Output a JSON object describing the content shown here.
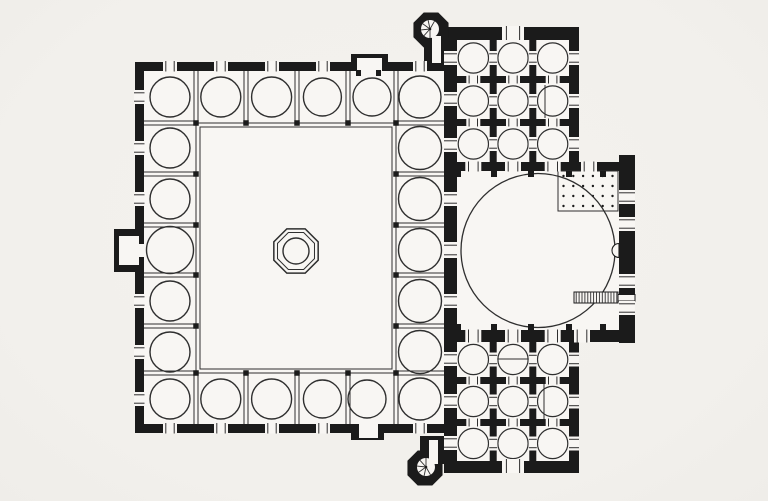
{
  "meta": {
    "description": "Scanned architectural floor plan of an Ottoman mosque: arcaded courtyard with central ablution fountain (left), domed prayer hall with flanking three-by-three domed wings (right), two spiral minarets, minbar and mihrab"
  },
  "palette": {
    "background": "#f2f0ec",
    "surface": "#f8f6f3",
    "ink": "#1b1b1b",
    "line": "#2f2f2f"
  },
  "canvas": {
    "width": 768,
    "height": 501
  },
  "plan": {
    "wallRects": [
      {
        "name": "courtyard-outer-wall",
        "r": [
          135,
          62,
          322,
          371
        ]
      },
      {
        "name": "shared-west-wall",
        "r": [
          444,
          28,
          13,
          445
        ]
      },
      {
        "name": "north-wing-block",
        "r": [
          444,
          27,
          135,
          144
        ]
      },
      {
        "name": "hall-north-wall-east",
        "r": [
          579,
          162,
          56,
          9
        ]
      },
      {
        "name": "hall-east-qibla-wall",
        "r": [
          619,
          155,
          16,
          188
        ]
      },
      {
        "name": "hall-south-wall",
        "r": [
          444,
          330,
          191,
          12
        ]
      },
      {
        "name": "south-wing-block",
        "r": [
          444,
          342,
          135,
          131
        ]
      }
    ],
    "floorRects": [
      {
        "name": "courtyard-arcade-floor",
        "r": [
          144,
          71,
          300,
          353
        ]
      },
      {
        "name": "prayer-hall-floor",
        "r": [
          457,
          171,
          162,
          159
        ]
      }
    ],
    "bays": [
      [
        457,
        40,
        32.7,
        36
      ],
      [
        496.7,
        40,
        32.6,
        36
      ],
      [
        536.3,
        40,
        32.7,
        36
      ],
      [
        457,
        83,
        32.7,
        36
      ],
      [
        496.7,
        83,
        32.6,
        36
      ],
      [
        536.3,
        83,
        32.7,
        36
      ],
      [
        457,
        126,
        32.7,
        36
      ],
      [
        496.7,
        126,
        32.6,
        36
      ],
      [
        536.3,
        126,
        32.7,
        36
      ],
      [
        457,
        342,
        32.7,
        35
      ],
      [
        496.7,
        342,
        32.6,
        35
      ],
      [
        536.3,
        342,
        32.7,
        35
      ],
      [
        457,
        384,
        32.7,
        35
      ],
      [
        496.7,
        384,
        32.6,
        35
      ],
      [
        536.3,
        384,
        32.7,
        35
      ],
      [
        457,
        426,
        32.7,
        35
      ],
      [
        496.7,
        426,
        32.6,
        35
      ],
      [
        536.3,
        426,
        32.7,
        35
      ]
    ],
    "arcadeFrame": [
      [
        196,
        123,
        200,
        250
      ],
      [
        200,
        127,
        192,
        242
      ]
    ],
    "dividers": [
      [
        "v",
        196,
        71,
        123
      ],
      [
        "v",
        246,
        71,
        123
      ],
      [
        "v",
        297,
        71,
        123
      ],
      [
        "v",
        348,
        71,
        123
      ],
      [
        "v",
        396,
        71,
        123
      ],
      [
        "v",
        196,
        373,
        424
      ],
      [
        "v",
        246,
        373,
        424
      ],
      [
        "v",
        297,
        373,
        424
      ],
      [
        "v",
        348,
        373,
        424
      ],
      [
        "v",
        396,
        373,
        424
      ],
      [
        "h",
        123,
        144,
        196
      ],
      [
        "h",
        174,
        144,
        196
      ],
      [
        "h",
        225,
        144,
        196
      ],
      [
        "h",
        275,
        144,
        196
      ],
      [
        "h",
        326,
        144,
        196
      ],
      [
        "h",
        373,
        144,
        196
      ],
      [
        "h",
        123,
        396,
        444
      ],
      [
        "h",
        174,
        396,
        444
      ],
      [
        "h",
        225,
        396,
        444
      ],
      [
        "h",
        275,
        396,
        444
      ],
      [
        "h",
        326,
        396,
        444
      ],
      [
        "h",
        373,
        396,
        444
      ]
    ],
    "piers": [
      [
        196,
        123
      ],
      [
        246,
        123
      ],
      [
        297,
        123
      ],
      [
        348,
        123
      ],
      [
        396,
        123
      ],
      [
        196,
        373
      ],
      [
        246,
        373
      ],
      [
        297,
        373
      ],
      [
        348,
        373
      ],
      [
        396,
        373
      ],
      [
        196,
        174
      ],
      [
        196,
        225
      ],
      [
        196,
        275
      ],
      [
        196,
        326
      ],
      [
        396,
        174
      ],
      [
        396,
        225
      ],
      [
        396,
        275
      ],
      [
        396,
        326
      ]
    ],
    "arcadeCircles": [
      [
        170,
        97,
        20
      ],
      [
        220.8,
        97,
        20
      ],
      [
        271.6,
        97,
        20
      ],
      [
        322.4,
        97,
        19
      ],
      [
        372,
        97,
        19
      ],
      [
        420,
        97,
        21
      ],
      [
        170,
        399,
        20
      ],
      [
        220.8,
        399,
        20
      ],
      [
        271.6,
        399,
        20
      ],
      [
        322.4,
        399,
        19
      ],
      [
        367,
        399,
        19
      ],
      [
        420,
        399,
        21
      ],
      [
        170,
        148,
        20
      ],
      [
        170,
        199,
        20
      ],
      [
        170,
        250,
        23.5
      ],
      [
        170,
        301,
        20
      ],
      [
        170,
        352,
        20
      ],
      [
        420,
        148,
        21.5
      ],
      [
        420,
        199,
        21.5
      ],
      [
        420,
        250,
        21.5
      ],
      [
        420,
        301,
        21.5
      ],
      [
        420,
        352,
        21.5
      ]
    ],
    "chordLines": [
      [
        545,
        85,
        545,
        118
      ],
      [
        497,
        359,
        530,
        359
      ],
      [
        544,
        384,
        544,
        419
      ]
    ],
    "windows": [
      [
        163,
        61,
        14,
        10.5,
        "h"
      ],
      [
        214,
        61,
        14,
        10.5,
        "h"
      ],
      [
        265,
        61,
        14,
        10.5,
        "h"
      ],
      [
        316,
        61,
        14,
        10.5,
        "h"
      ],
      [
        413,
        61,
        14,
        10.5,
        "h"
      ],
      [
        163,
        423,
        14,
        10.5,
        "h"
      ],
      [
        214,
        423,
        14,
        10.5,
        "h"
      ],
      [
        265,
        423,
        14,
        10.5,
        "h"
      ],
      [
        316,
        423,
        14,
        10.5,
        "h"
      ],
      [
        413,
        423,
        14,
        10.5,
        "h"
      ],
      [
        134,
        90,
        10.5,
        14,
        "v"
      ],
      [
        134,
        141,
        10.5,
        14,
        "v"
      ],
      [
        134,
        192,
        10.5,
        14,
        "v"
      ],
      [
        134,
        294,
        10.5,
        14,
        "v"
      ],
      [
        134,
        345,
        10.5,
        14,
        "v"
      ],
      [
        134,
        392,
        10.5,
        14,
        "v"
      ],
      [
        444,
        51,
        13,
        14,
        "v"
      ],
      [
        444,
        92,
        13,
        14,
        "v"
      ],
      [
        444,
        138,
        13,
        14,
        "v"
      ],
      [
        444,
        192,
        13,
        14,
        "v"
      ],
      [
        444,
        242,
        13,
        16,
        "v"
      ],
      [
        444,
        294,
        13,
        14,
        "v"
      ],
      [
        444,
        352,
        13,
        14,
        "v"
      ],
      [
        444,
        394,
        13,
        14,
        "v"
      ],
      [
        444,
        436,
        13,
        14,
        "v"
      ],
      [
        569,
        51,
        10,
        14,
        "v"
      ],
      [
        569,
        94,
        10,
        14,
        "v"
      ],
      [
        569,
        137,
        10,
        14,
        "v"
      ],
      [
        569,
        352.5,
        10,
        14,
        "v"
      ],
      [
        569,
        394.5,
        10,
        14,
        "v"
      ],
      [
        569,
        436.5,
        10,
        14,
        "v"
      ],
      [
        619,
        190,
        16,
        14,
        "v"
      ],
      [
        619,
        217,
        16,
        14,
        "v"
      ],
      [
        619,
        274,
        16,
        14,
        "v"
      ],
      [
        619,
        301,
        16,
        14,
        "v"
      ],
      [
        502,
        26,
        22,
        14,
        "h"
      ],
      [
        502,
        459,
        22,
        14,
        "h"
      ],
      [
        489.2,
        51,
        8,
        14,
        "v"
      ],
      [
        489.2,
        94,
        8,
        14,
        "v"
      ],
      [
        489.2,
        137,
        8,
        14,
        "v"
      ],
      [
        528.8,
        51,
        8,
        14,
        "v"
      ],
      [
        528.8,
        94,
        8,
        14,
        "v"
      ],
      [
        528.8,
        137,
        8,
        14,
        "v"
      ],
      [
        466.3,
        75.5,
        14,
        8,
        "h"
      ],
      [
        506,
        75.5,
        14,
        8,
        "h"
      ],
      [
        545.7,
        75.5,
        14,
        8,
        "h"
      ],
      [
        466.3,
        118.5,
        14,
        8,
        "h"
      ],
      [
        506,
        118.5,
        14,
        8,
        "h"
      ],
      [
        545.7,
        118.5,
        14,
        8,
        "h"
      ],
      [
        489.2,
        352.5,
        8,
        14,
        "v"
      ],
      [
        489.2,
        394.5,
        8,
        14,
        "v"
      ],
      [
        489.2,
        436.5,
        8,
        14,
        "v"
      ],
      [
        528.8,
        352.5,
        8,
        14,
        "v"
      ],
      [
        528.8,
        394.5,
        8,
        14,
        "v"
      ],
      [
        528.8,
        436.5,
        8,
        14,
        "v"
      ],
      [
        466.3,
        376.5,
        14,
        8,
        "h"
      ],
      [
        506,
        376.5,
        14,
        8,
        "h"
      ],
      [
        545.7,
        376.5,
        14,
        8,
        "h"
      ],
      [
        466.3,
        418.5,
        14,
        8,
        "h"
      ],
      [
        506,
        418.5,
        14,
        8,
        "h"
      ],
      [
        545.7,
        418.5,
        14,
        8,
        "h"
      ],
      [
        465.3,
        161.5,
        16,
        10,
        "h"
      ],
      [
        505,
        161.5,
        16,
        10,
        "h"
      ],
      [
        544.7,
        161.5,
        16,
        10,
        "h"
      ],
      [
        581,
        161.5,
        16,
        10,
        "h"
      ],
      [
        465.3,
        329.5,
        16,
        13,
        "h"
      ],
      [
        505,
        329.5,
        16,
        13,
        "h"
      ],
      [
        544.7,
        329.5,
        16,
        13,
        "h"
      ],
      [
        574,
        329.5,
        16,
        13,
        "h"
      ]
    ],
    "hallPiers": [
      [
        458,
        171
      ],
      [
        494,
        171
      ],
      [
        531,
        171
      ],
      [
        569,
        171
      ],
      [
        603,
        171
      ],
      [
        458,
        324
      ],
      [
        494,
        324
      ],
      [
        531,
        324
      ],
      [
        569,
        324
      ],
      [
        603,
        324
      ]
    ],
    "dome": {
      "cx": 538,
      "cy": 250.5,
      "r": 77
    },
    "platform": {
      "x": 558,
      "y": 171,
      "w": 60,
      "h": 40,
      "cols": 6,
      "rows": 4
    },
    "minbar": {
      "x": 574,
      "y": 292,
      "w": 44,
      "h": 11,
      "step": 2.9,
      "neck": [
        618,
        294.5,
        17,
        6.5
      ]
    },
    "mihrab": {
      "cx": 619,
      "cy": 250.5,
      "r": 7
    },
    "fountain": {
      "cx": 296,
      "cy": 251,
      "rOuter": 24,
      "rInner": 20,
      "rBasin": 13
    },
    "portals": {
      "west": {
        "block": [
          114,
          229,
          31,
          43
        ],
        "recess": [
          119,
          236,
          20,
          29
        ],
        "passage": [
          139,
          244,
          7,
          13
        ]
      },
      "north": {
        "block": [
          351,
          54,
          37,
          18
        ],
        "recess": [
          357,
          58,
          25,
          20
        ],
        "jambs": [
          [
            356,
            70,
            5,
            6
          ],
          [
            376,
            70,
            5,
            6
          ]
        ]
      },
      "south": {
        "block": [
          351,
          418,
          33,
          22
        ],
        "recess": [
          359,
          422,
          19,
          16
        ]
      }
    },
    "minarets": [
      {
        "name": "northwest-minaret",
        "cx": 431,
        "cy": 30,
        "r": 19,
        "connector": [
          424,
          34,
          26,
          30
        ],
        "corridor": [
          432,
          36,
          9,
          27
        ],
        "fan": {
          "cx": 430,
          "cy": 29,
          "r": 9,
          "a0": 90,
          "a1": 300
        }
      },
      {
        "name": "southwest-minaret",
        "cx": 425,
        "cy": 468,
        "r": 19,
        "connector": [
          420,
          436,
          28,
          28
        ],
        "corridor": [
          429,
          440,
          9,
          24
        ],
        "fan": {
          "cx": 426,
          "cy": 467,
          "r": 9,
          "a0": 60,
          "a1": 270
        }
      }
    ]
  }
}
